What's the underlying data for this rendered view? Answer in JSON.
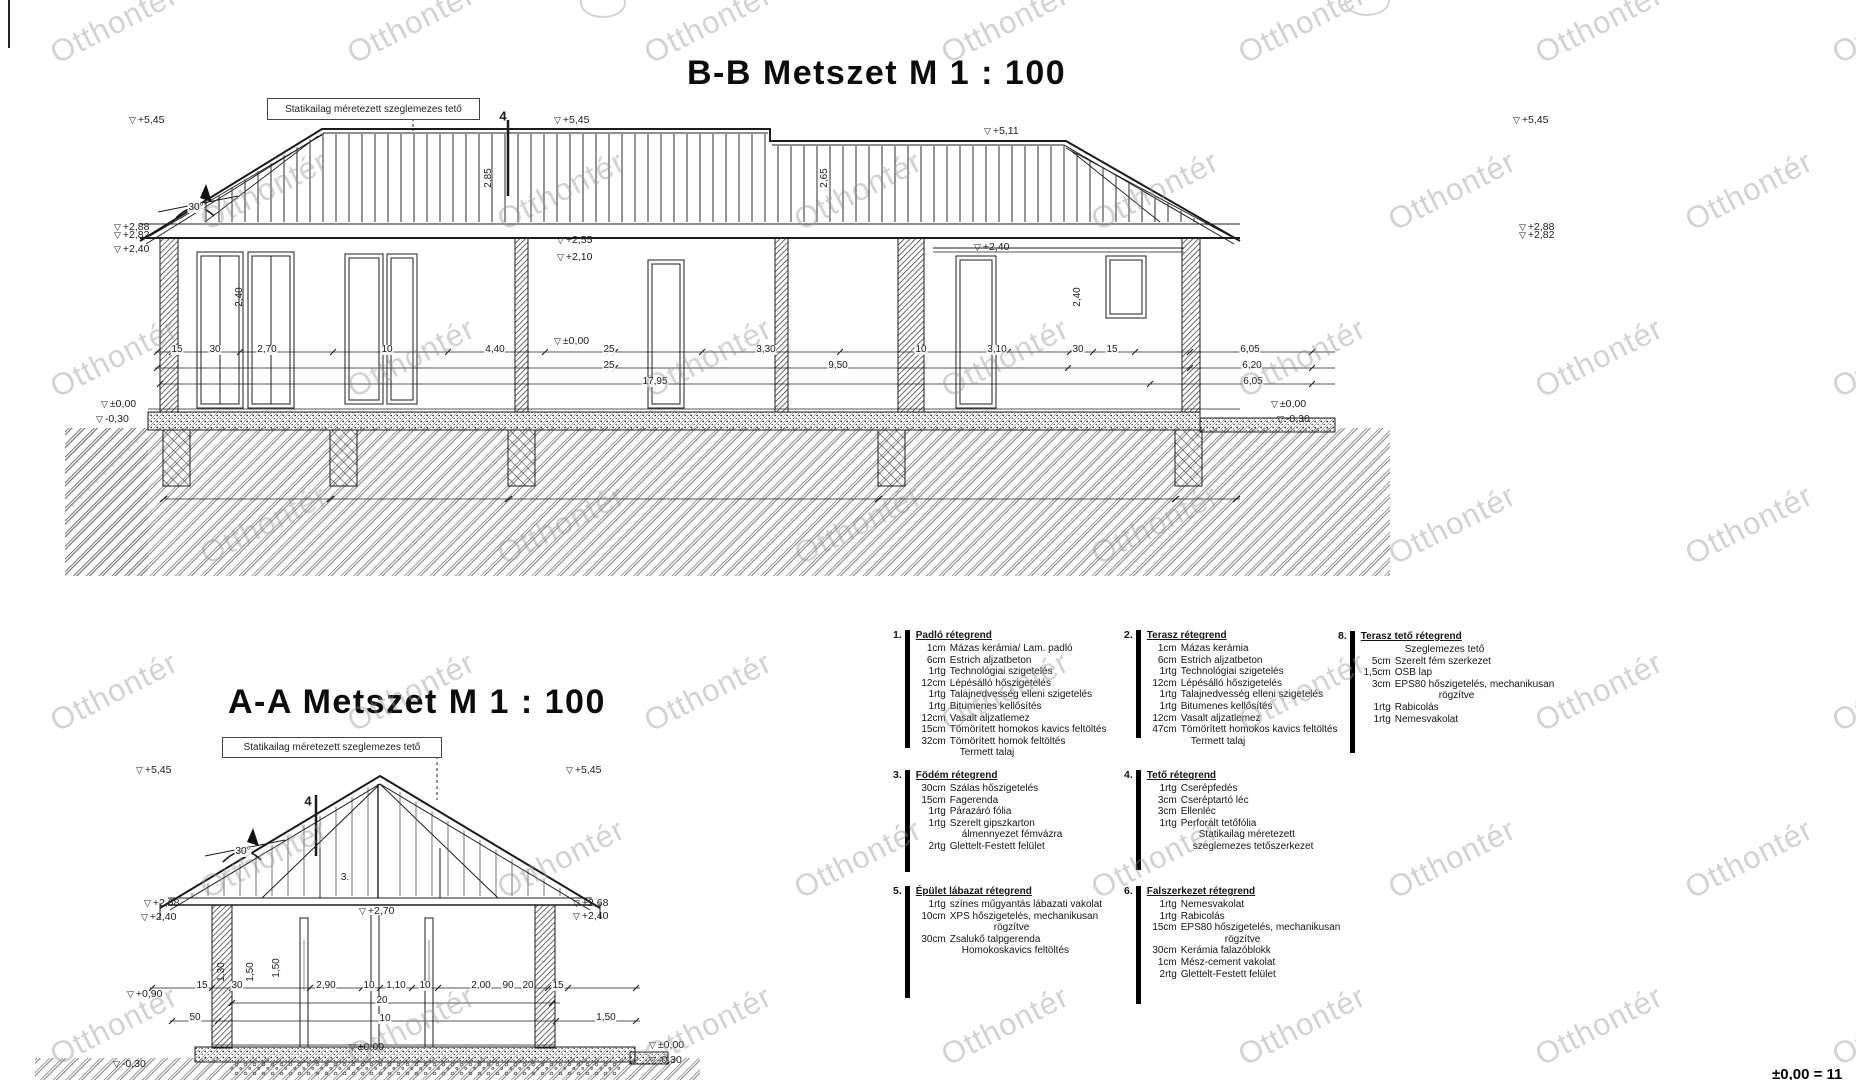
{
  "watermark": {
    "text": "Otthontér"
  },
  "titles": {
    "bb": "B-B Metszet M 1 : 100",
    "aa": "A-A Metszet M 1 : 100"
  },
  "roof_label_bb": "Statikailag méretezett szeglemezes tető",
  "roof_label_aa": "Statikailag méretezett szeglemezes tető",
  "footer_note": "±0,00 = 11",
  "bb": {
    "levels": [
      {
        "t": "+5,45",
        "x": 128,
        "y": 120,
        "m": 1
      },
      {
        "t": "+5,45",
        "x": 553,
        "y": 120,
        "m": 1
      },
      {
        "t": "+5,11",
        "x": 983,
        "y": 131,
        "m": 1
      },
      {
        "t": "+5,45",
        "x": 1512,
        "y": 120,
        "m": 1
      },
      {
        "t": "+2,88",
        "x": 113,
        "y": 227,
        "m": 1
      },
      {
        "t": "+2,82",
        "x": 113,
        "y": 235,
        "m": 1
      },
      {
        "t": "+2,40",
        "x": 113,
        "y": 249,
        "m": 1
      },
      {
        "t": "+2,88",
        "x": 1518,
        "y": 227,
        "m": 1
      },
      {
        "t": "+2,82",
        "x": 1518,
        "y": 235,
        "m": 1
      },
      {
        "t": "+2,55",
        "x": 556,
        "y": 240,
        "m": 1
      },
      {
        "t": "+2,10",
        "x": 556,
        "y": 257,
        "m": 1
      },
      {
        "t": "+2,40",
        "x": 973,
        "y": 247,
        "m": 1
      },
      {
        "t": "±0,00",
        "x": 553,
        "y": 341,
        "m": 1
      },
      {
        "t": "±0,00",
        "x": 100,
        "y": 404,
        "m": 1
      },
      {
        "t": "-0,30",
        "x": 95,
        "y": 419,
        "m": 1
      },
      {
        "t": "±0,00",
        "x": 1270,
        "y": 404,
        "m": 1
      },
      {
        "t": "-0,30",
        "x": 1276,
        "y": 419,
        "m": 1
      }
    ],
    "dims": [
      {
        "t": "15",
        "x": 177,
        "y": 350
      },
      {
        "t": "30",
        "x": 215,
        "y": 350
      },
      {
        "t": "2,70",
        "x": 267,
        "y": 350
      },
      {
        "t": "10",
        "x": 387,
        "y": 350
      },
      {
        "t": "4,40",
        "x": 495,
        "y": 350
      },
      {
        "t": "25",
        "x": 609,
        "y": 350
      },
      {
        "t": "3,30",
        "x": 766,
        "y": 350
      },
      {
        "t": "10",
        "x": 921,
        "y": 350
      },
      {
        "t": "3,10",
        "x": 997,
        "y": 350
      },
      {
        "t": "30",
        "x": 1078,
        "y": 350
      },
      {
        "t": "15",
        "x": 1112,
        "y": 350
      },
      {
        "t": "6,05",
        "x": 1250,
        "y": 350
      },
      {
        "t": "25",
        "x": 609,
        "y": 366
      },
      {
        "t": "9,50",
        "x": 838,
        "y": 366
      },
      {
        "t": "6,20",
        "x": 1252,
        "y": 366
      },
      {
        "t": "17,95",
        "x": 655,
        "y": 382
      },
      {
        "t": "6,05",
        "x": 1253,
        "y": 382
      },
      {
        "t": "2,85",
        "x": 489,
        "y": 178,
        "r": 1
      },
      {
        "t": "2,65",
        "x": 825,
        "y": 178,
        "r": 1
      },
      {
        "t": "2,40",
        "x": 240,
        "y": 297,
        "r": 1
      },
      {
        "t": "2,40",
        "x": 1078,
        "y": 297,
        "r": 1
      },
      {
        "t": "4",
        "x": 503,
        "y": 116,
        "b": 1
      },
      {
        "t": "30°",
        "x": 196,
        "y": 208
      }
    ]
  },
  "aa": {
    "levels": [
      {
        "t": "+5,45",
        "x": 135,
        "y": 770,
        "m": 1
      },
      {
        "t": "+5,45",
        "x": 565,
        "y": 770,
        "m": 1
      },
      {
        "t": "+2,68",
        "x": 143,
        "y": 903,
        "m": 1
      },
      {
        "t": "+2,40",
        "x": 140,
        "y": 917,
        "m": 1
      },
      {
        "t": "+2,68",
        "x": 572,
        "y": 903,
        "m": 1
      },
      {
        "t": "+2,40",
        "x": 572,
        "y": 916,
        "m": 1
      },
      {
        "t": "+2,70",
        "x": 358,
        "y": 911,
        "m": 1
      },
      {
        "t": "+0,90",
        "x": 126,
        "y": 994,
        "m": 1
      },
      {
        "t": "-0,30",
        "x": 112,
        "y": 1064,
        "m": 1
      },
      {
        "t": "±0,00",
        "x": 348,
        "y": 1047,
        "m": 1
      },
      {
        "t": "±0,00",
        "x": 648,
        "y": 1045,
        "m": 1
      },
      {
        "t": "-0,30",
        "x": 648,
        "y": 1060,
        "m": 1
      }
    ],
    "dims": [
      {
        "t": "15",
        "x": 202,
        "y": 986
      },
      {
        "t": "30",
        "x": 237,
        "y": 986
      },
      {
        "t": "2,90",
        "x": 326,
        "y": 986
      },
      {
        "t": "10",
        "x": 369,
        "y": 986
      },
      {
        "t": "1,10",
        "x": 396,
        "y": 986
      },
      {
        "t": "10",
        "x": 425,
        "y": 986
      },
      {
        "t": "2,00",
        "x": 481,
        "y": 986
      },
      {
        "t": "90",
        "x": 508,
        "y": 986
      },
      {
        "t": "20",
        "x": 528,
        "y": 986
      },
      {
        "t": "15",
        "x": 558,
        "y": 986
      },
      {
        "t": "20",
        "x": 382,
        "y": 1001
      },
      {
        "t": "50",
        "x": 195,
        "y": 1018
      },
      {
        "t": "10",
        "x": 385,
        "y": 1019
      },
      {
        "t": "1,50",
        "x": 606,
        "y": 1018
      },
      {
        "t": "1,30",
        "x": 222,
        "y": 972,
        "r": 1
      },
      {
        "t": "1,50",
        "x": 251,
        "y": 972,
        "r": 1
      },
      {
        "t": "1,50",
        "x": 277,
        "y": 968,
        "r": 1
      },
      {
        "t": "4",
        "x": 308,
        "y": 801,
        "b": 1
      },
      {
        "t": "3.",
        "x": 345,
        "y": 878
      },
      {
        "t": "30°",
        "x": 243,
        "y": 852
      }
    ]
  },
  "legend": {
    "blocks": [
      {
        "num": "1.",
        "title": "Padló rétegrend",
        "items": [
          {
            "q": "1cm",
            "t": "Mázas kerámia/ Lam. padló"
          },
          {
            "q": "6cm",
            "t": "Estrich aljzatbeton"
          },
          {
            "q": "1rtg",
            "t": "Technológiai szigetelés"
          },
          {
            "q": "12cm",
            "t": "Lépésálló hőszigetelés"
          },
          {
            "q": "1rtg",
            "t": "Talajnedvesség elleni szigetelés"
          },
          {
            "q": "1rtg",
            "t": "Bitumenes kellősítés"
          },
          {
            "q": "12cm",
            "t": "Vasalt aljzatlemez"
          },
          {
            "q": "15cm",
            "t": "Tömörített homokos kavics feltöltés"
          },
          {
            "q": "32cm",
            "t": "Tömörített homok feltöltés"
          },
          {
            "q": "",
            "t": "Termett talaj",
            "i": 10
          }
        ]
      },
      {
        "num": "2.",
        "title": "Terasz rétegrend",
        "items": [
          {
            "q": "1cm",
            "t": "Mázas kerámia"
          },
          {
            "q": "6cm",
            "t": "Estrich aljzatbeton"
          },
          {
            "q": "1rtg",
            "t": "Technológiai szigetelés"
          },
          {
            "q": "12cm",
            "t": "Lépésálló hőszigetelés"
          },
          {
            "q": "1rtg",
            "t": "Talajnedvesség elleni szigetelés"
          },
          {
            "q": "1rtg",
            "t": "Bitumenes kellősítés"
          },
          {
            "q": "12cm",
            "t": "Vasalt aljzatlemez"
          },
          {
            "q": "47cm",
            "t": "Tömörített homokos kavics feltöltés"
          },
          {
            "q": "",
            "t": "Termett talaj",
            "i": 10
          }
        ]
      },
      {
        "num": "8.",
        "title": "Terasz tető rétegrend",
        "items": [
          {
            "q": "",
            "t": "Szeglemezes tető",
            "i": 10
          },
          {
            "q": "5cm",
            "t": "Szerelt fém szerkezet"
          },
          {
            "q": "1,5cm",
            "t": "OSB lap"
          },
          {
            "q": "3cm",
            "t": "EPS80 hőszigetelés, mechanikusan"
          },
          {
            "q": "",
            "t": "rögzítve",
            "i": 44
          },
          {
            "q": "1rtg",
            "t": "Rabicolás"
          },
          {
            "q": "1rtg",
            "t": "Nemesvakolat"
          }
        ]
      },
      {
        "num": "3.",
        "title": "Födém rétegrend",
        "items": [
          {
            "q": "30cm",
            "t": "Szálas hőszigetelés"
          },
          {
            "q": "15cm",
            "t": "Fagerenda"
          },
          {
            "q": "1rtg",
            "t": "Párazáró fólia"
          },
          {
            "q": "1rtg",
            "t": "Szerelt gipszkarton"
          },
          {
            "q": "",
            "t": "álmennyezet fémvázra",
            "i": 12
          },
          {
            "q": "2rtg",
            "t": "Glettelt-Festett felület"
          }
        ]
      },
      {
        "num": "4.",
        "title": "Tető rétegrend",
        "items": [
          {
            "q": "1rtg",
            "t": "Cserépfedés"
          },
          {
            "q": "3cm",
            "t": "Cseréptartó léc"
          },
          {
            "q": "3cm",
            "t": "Ellenléc"
          },
          {
            "q": "1rtg",
            "t": "Perforált tetőfólia"
          },
          {
            "q": "",
            "t": "Statikailag méretezett",
            "i": 18
          },
          {
            "q": "",
            "t": "szeglemezes tetőszerkezet",
            "i": 12
          }
        ]
      },
      {
        "num": "5.",
        "title": "Épület lábazat rétegrend",
        "items": [
          {
            "q": "1rtg",
            "t": "színes műgyantás lábazati vakolat"
          },
          {
            "q": "10cm",
            "t": "XPS hőszigetelés, mechanikusan"
          },
          {
            "q": "",
            "t": "rögzítve",
            "i": 44
          },
          {
            "q": "30cm",
            "t": "Zsalukő talpgerenda"
          },
          {
            "q": "",
            "t": "Homokoskavics feltöltés",
            "i": 12
          }
        ]
      },
      {
        "num": "6.",
        "title": "Falszerkezet rétegrend",
        "items": [
          {
            "q": "1rtg",
            "t": "Nemesvakolat"
          },
          {
            "q": "1rtg",
            "t": "Rabicolás"
          },
          {
            "q": "15cm",
            "t": "EPS80 hőszigetelés, mechanikusan"
          },
          {
            "q": "",
            "t": "rögzítve",
            "i": 44
          },
          {
            "q": "30cm",
            "t": "Kerámia falazóblokk"
          },
          {
            "q": "1cm",
            "t": "Mész-cement vakolat"
          },
          {
            "q": "2rtg",
            "t": "Glettelt-Festett felület"
          }
        ]
      }
    ]
  }
}
